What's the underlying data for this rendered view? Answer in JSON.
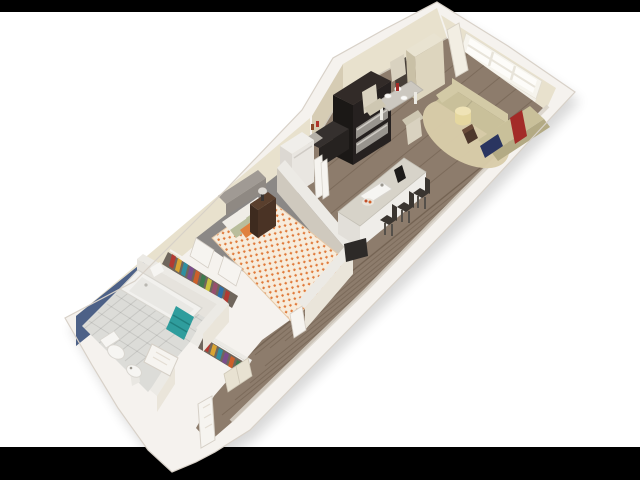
{
  "canvas": {
    "width": 640,
    "height": 480,
    "top_bar_height": 12,
    "bottom_bar_height": 33
  },
  "colors": {
    "letterbox": "#000000",
    "background": "#ffffff",
    "wall_outer": "#f5f2ee",
    "wall_outline": "#d8d1c8",
    "wall_top": "#eceae5",
    "wall_inner_cream": "#e8e1cd",
    "wall_inner_tan": "#d6ccb4",
    "wall_inner_grey_face": "#cfc9be",
    "wall_inner_light": "#eae5da",
    "accent_blue": "#4d6187",
    "frame_gold": "#a98d4e",
    "floor_wood": "#8d7c6c",
    "floor_carpet": "#8b8886",
    "floor_tile": "#dcdcd8",
    "window_frame": "#f6f4ed",
    "window_pane": "#fdfcf9",
    "sofa": "#c9c09a",
    "sofa_back": "#d3caa6",
    "sofa_shadow": "#b3aa84",
    "rug": "#d9cca9",
    "ottoman": "#e5d79f",
    "ottoman_top": "#efe3b6",
    "accent_red": "#a32b28",
    "accent_navy": "#2a3560",
    "decor_brown": "#4e382c",
    "cabinet_dark": "#262120",
    "cabinet_top": "#322b28",
    "stainless": "#98948e",
    "counter_dark": "#35302e",
    "counter_speckle": "#b5b0a8",
    "island_top": "#d7d3c9",
    "island_side": "#efede9",
    "island_side2": "#e2dfd9",
    "stool_dark": "#3a3530",
    "table_top": "#ccc8c0",
    "chair_beige": "#d9d2c0",
    "fridge": "#f0eeea",
    "fridge_front": "#e9e6e1",
    "fridge_side": "#dcd8d2",
    "tall_cabinet": "#ddd5be",
    "tall_cabinet_side": "#c9c0a6",
    "tall_cabinet_top": "#e9e3d1",
    "panel_lean": "#f2eee3",
    "headboard": "#a09a94",
    "headboard_front": "#8f8983",
    "duvet_base": "#f7ecdc",
    "duvet_orange": "#e07a3a",
    "pillow_white": "#f0ede7",
    "pillow_sage": "#b9bd9c",
    "pillow_orange": "#e0813e",
    "nightstand": "#4a3325",
    "nightstand_top": "#5a3f2d",
    "lamp_shade": "#dedad4",
    "tv_dark": "#2d2a28",
    "closet_interior": "#6f665c",
    "door_white": "#f6f4f0",
    "door_stroke": "#d6d0c7",
    "tub_white": "#f2f1ee",
    "tub_inner": "#e9e8e4",
    "fixture_white": "#f6f5f2",
    "towel_teal": "#2f9d9d",
    "clothes": [
      "#b23a32",
      "#d9a433",
      "#2f8fa0",
      "#7a4d8c",
      "#cc5f2a",
      "#3d7a4f",
      "#c8c23e",
      "#974f6d",
      "#2f6fa8",
      "#b23a32",
      "#d9a433",
      "#2f8fa0",
      "#7a4d8c",
      "#cc5f2a",
      "#3d7a4f",
      "#c8c23e"
    ]
  },
  "scene": {
    "type": "3d-floor-plan-render",
    "rooms": [
      "living-room",
      "dining-area",
      "kitchen",
      "bedroom",
      "closets",
      "bathroom",
      "entry-hall"
    ],
    "furniture": [
      "loveseat-sofa",
      "sectional-sofa",
      "round-rug",
      "ottoman",
      "side-decor",
      "paned-window",
      "leaning-panel",
      "tall-cabinet",
      "dining-table",
      "dining-chairs",
      "kitchen-cabinets",
      "range-unit",
      "refrigerator",
      "kitchen-island",
      "island-sink",
      "bar-stools",
      "bed",
      "headboard",
      "nightstand",
      "table-lamp",
      "wall-tv",
      "hanging-clothes",
      "closet-doors",
      "bathtub",
      "teal-towel",
      "toilet",
      "pedestal-sink",
      "framed-art",
      "entry-door",
      "bathroom-door"
    ]
  }
}
